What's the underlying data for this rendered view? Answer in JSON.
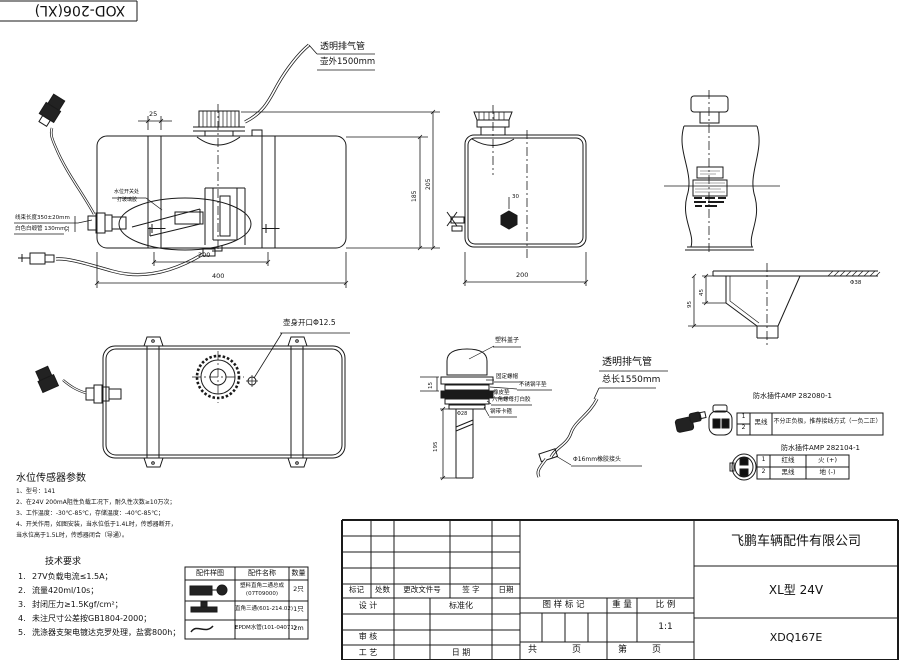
{
  "sheet": {
    "corner_code": "XOD-206(XL)"
  },
  "labels": {
    "vent_top": {
      "l1": "透明排气管",
      "l2": "壶外1500mm"
    },
    "vent_mid": {
      "l1": "透明排气管",
      "l2": "总长1550mm"
    },
    "harness": {
      "l1": "线束长度350±20mm",
      "l2": "白色白缎管 130mm"
    },
    "glue": {
      "l1": "水位开关处",
      "l2": "打玻璃胶"
    },
    "opening": "壶身开口Φ12.5",
    "rubber_joint": "Φ16mm橡胶接头"
  },
  "dims": {
    "strap_w": "25",
    "strap_sp": "200",
    "len": "400",
    "h_body": "185",
    "h_total": "205",
    "sensor_d": "32",
    "side_w": "200",
    "plug_off": "30",
    "washer": "15",
    "tube_len": "195",
    "tube_d": "Φ28",
    "funnel_h1": "45",
    "funnel_h2": "95",
    "funnel_d": "Φ38"
  },
  "sensor_detail": {
    "cap": "塑料盖子",
    "nut": "固定螺帽",
    "washer": "不锈钢平垫",
    "rubber": "橡皮垫",
    "hexnut": "六角螺母打白胶",
    "clamp": "钢带卡箍"
  },
  "connectors": {
    "c1": {
      "title": "防水插件AMP 282080-1",
      "pin1": "1",
      "pin2": "2",
      "wire": "黑线",
      "note": "不分正负极，推荐接线方式（一负二正）"
    },
    "c2": {
      "title": "防水插件AMP 282104-1",
      "rows": [
        {
          "pin": "1",
          "wire": "红线",
          "pol": "火 (+)"
        },
        {
          "pin": "2",
          "wire": "黑线",
          "pol": "地 (-)"
        }
      ]
    }
  },
  "sensor_params": {
    "title": "水位传感器参数",
    "lines": [
      "1、型号：141",
      "2、在24V 200mA阻性负载工况下，耐久性次数≥10万次；",
      "3、工作温度：-30℃-85℃，存储温度：-40℃-85℃；",
      "4、开关作用，如图安装，当水位低于1.4L时，传感器断开，",
      "当水位高于1.5L时，传感器闭合（导通）。"
    ]
  },
  "tech_req": {
    "title": "技术要求",
    "items": [
      {
        "no": "1.",
        "text": "27V负载电流≤1.5A；"
      },
      {
        "no": "2.",
        "text": "流量420ml/10s；"
      },
      {
        "no": "3.",
        "text": "封闭压力≥1.5Kgf/cm²；"
      },
      {
        "no": "4.",
        "text": "未注尺寸公差按GB1804-2000；"
      },
      {
        "no": "5.",
        "text": "洗涤器支架电镀达克罗处理，盐雾800h；"
      }
    ]
  },
  "parts_table": {
    "headers": [
      "配件样图",
      "配件名称",
      "数量"
    ],
    "rows": [
      {
        "name1": "塑料直角二通总成",
        "name2": "(07T09000)",
        "qty": "2只"
      },
      {
        "name1": "直角三通(601-214.02)",
        "name2": "",
        "qty": "1只"
      },
      {
        "name1": "EPDM水管(101-04071)",
        "name2": "",
        "qty": "2m"
      }
    ]
  },
  "title_block": {
    "rev_headers": [
      "标记",
      "处数",
      "更改文件号",
      "签 字",
      "日期"
    ],
    "design": "设 计",
    "standard": "标准化",
    "audit": "审 核",
    "process": "工 艺",
    "date": "日 期",
    "mark_label": "图 样 标 记",
    "weight_label": "重 量",
    "scale_label": "比 例",
    "scale_value": "1:1",
    "total_label": "共",
    "page_label": "页",
    "no_label": "第",
    "page_label2": "页",
    "company": "飞鹏车辆配件有限公司",
    "product": "XL型 24V",
    "code": "XDQ167E"
  }
}
